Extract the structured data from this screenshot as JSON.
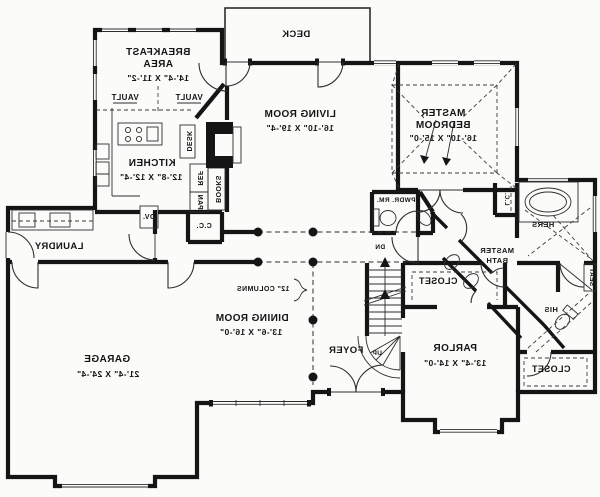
{
  "rooms": {
    "deck": {
      "label": "DECK"
    },
    "breakfast": {
      "line1": "BREAKFAST",
      "line2": "AREA",
      "dims": "14'-4\" X 11'-2\""
    },
    "kitchen": {
      "label": "KITCHEN",
      "dims": "12'-8\" X 12'-4\""
    },
    "living_room": {
      "label": "LIVING ROOM",
      "dims": "16'-10\" X 19'-4\""
    },
    "master_bedroom": {
      "line1": "MASTER",
      "line2": "BEDROOM",
      "dims": "16'-10\" X 15'-0\""
    },
    "laundry": {
      "label": "LAUNDRY"
    },
    "garage": {
      "label": "GARAGE",
      "dims": "21'-4\" X 24'-4\""
    },
    "dining_room": {
      "label": "DINING ROOM",
      "dims": "13'-6\" X 16'-0\""
    },
    "foyer": {
      "label": "FOYER"
    },
    "parlor": {
      "label": "PARLOR",
      "dims": "13'-4\" X 14'-0\""
    },
    "powder_room": {
      "label": "PWDR. RM."
    },
    "master_bath": {
      "line1": "MASTER",
      "line2": "BATH"
    },
    "hall_closet": {
      "label": "CLOSET"
    },
    "parlor_closet": {
      "label": "CLOSET"
    },
    "hers_closet": {
      "label": "HERS"
    },
    "his_closet": {
      "label": "HIS"
    },
    "linen_closet": {
      "label": "L.C."
    },
    "coat_closet": {
      "label": "C.C."
    }
  },
  "annotations": {
    "vault": "VAULT",
    "columns": "12\" COLUMNS",
    "stair_down": "DN",
    "stair_up": "UP",
    "seat": "SEAT",
    "oven": "OV.",
    "refrigerator": "REF",
    "pantry": "PAN",
    "bookshelf": "BOOKS",
    "desk": "DESK"
  },
  "colors": {
    "walls": "#151515",
    "thin_lines": "#2e2e2e",
    "background": "#fbfbfa"
  }
}
